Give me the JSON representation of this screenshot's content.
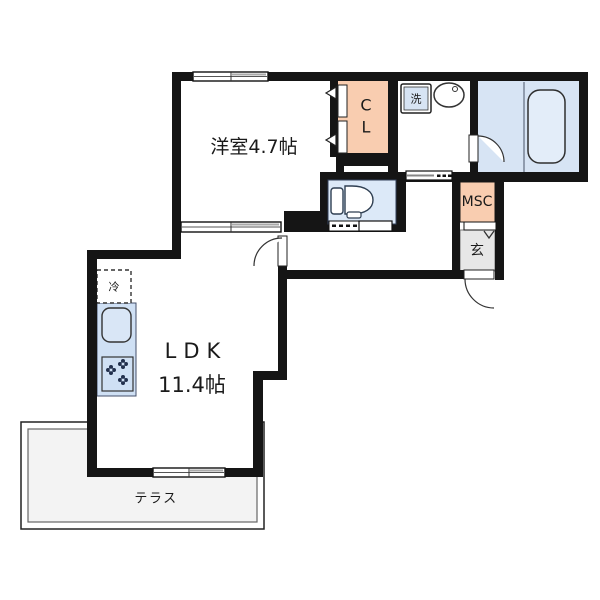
{
  "plan": {
    "type": "floor-plan",
    "rooms": {
      "western_room": {
        "label": "洋室4.7帖"
      },
      "ldk": {
        "name": "LDK",
        "size": "11.4帖"
      },
      "closet": {
        "line1": "C",
        "line2": "L"
      },
      "laundry": {
        "label": "洗"
      },
      "storage": {
        "label": "MSC"
      },
      "entrance": {
        "label": "玄"
      },
      "refrigerator": {
        "label": "冷"
      },
      "terrace": {
        "label": "テラス"
      }
    },
    "palette": {
      "wall": "#151515",
      "room_blue": "#D7E4F4",
      "counter_blue": "#CFE0F4",
      "tub_blue": "#E3EDF9",
      "accent_peach": "#F9CDB0",
      "genkan_gray": "#E7E7E7",
      "terrace_gray": "#F3F3F3",
      "text": "#1a1a1a"
    }
  }
}
